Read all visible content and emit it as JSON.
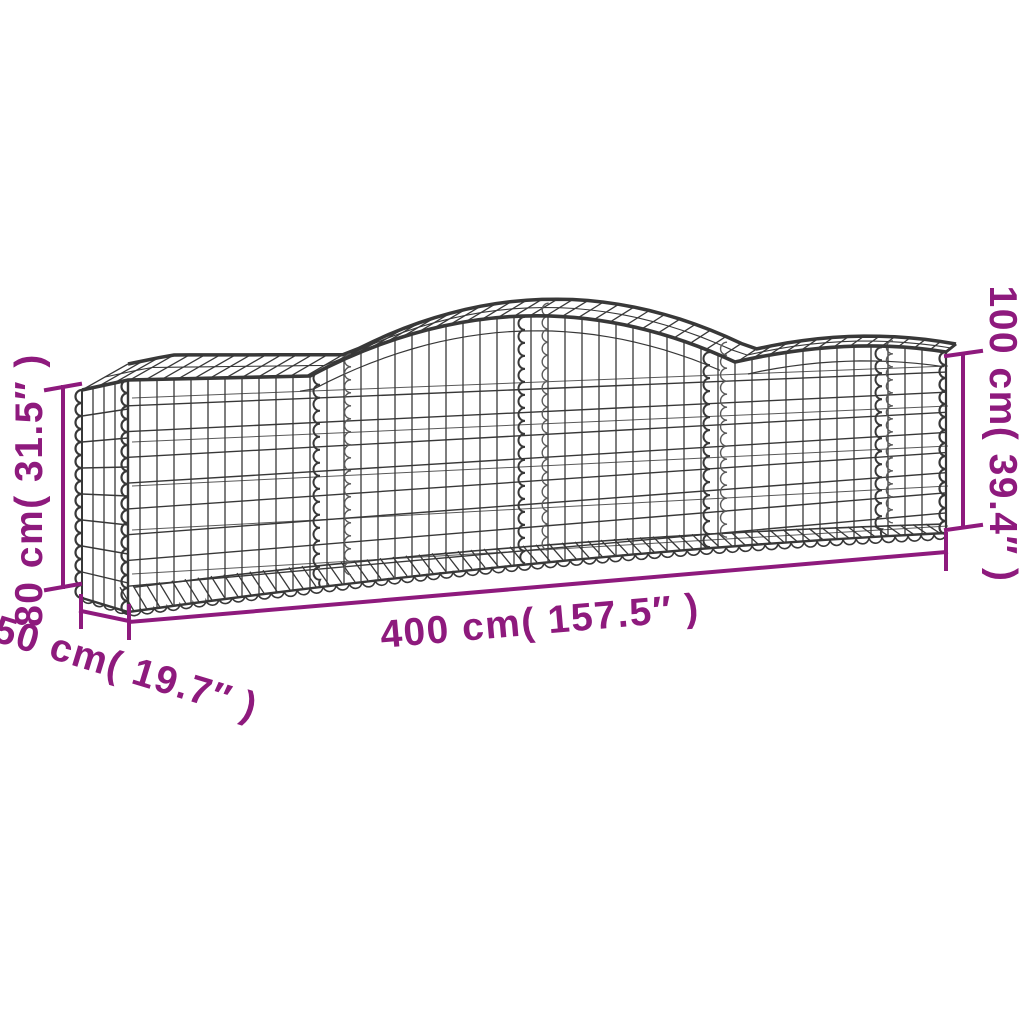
{
  "diagram": {
    "subject": "arched gabion basket wireframe",
    "background_color": "#ffffff",
    "wire_color": "#383838",
    "wire_back_color": "#5a5a5a",
    "dimension_color": "#8e1a7d",
    "dimensions": {
      "length": {
        "label": "400 cm( 157.5″ )",
        "value_cm": "400",
        "value_inch": "157.5"
      },
      "depth": {
        "label": "50 cm( 19.7″ )",
        "value_cm": "50",
        "value_inch": "19.7"
      },
      "height_min": {
        "label": "80 cm( 31.5″ )",
        "value_cm": "80",
        "value_inch": "31.5"
      },
      "height_max": {
        "label": "100 cm( 39.4″ )",
        "value_cm": "100",
        "value_inch": "39.4"
      }
    }
  }
}
